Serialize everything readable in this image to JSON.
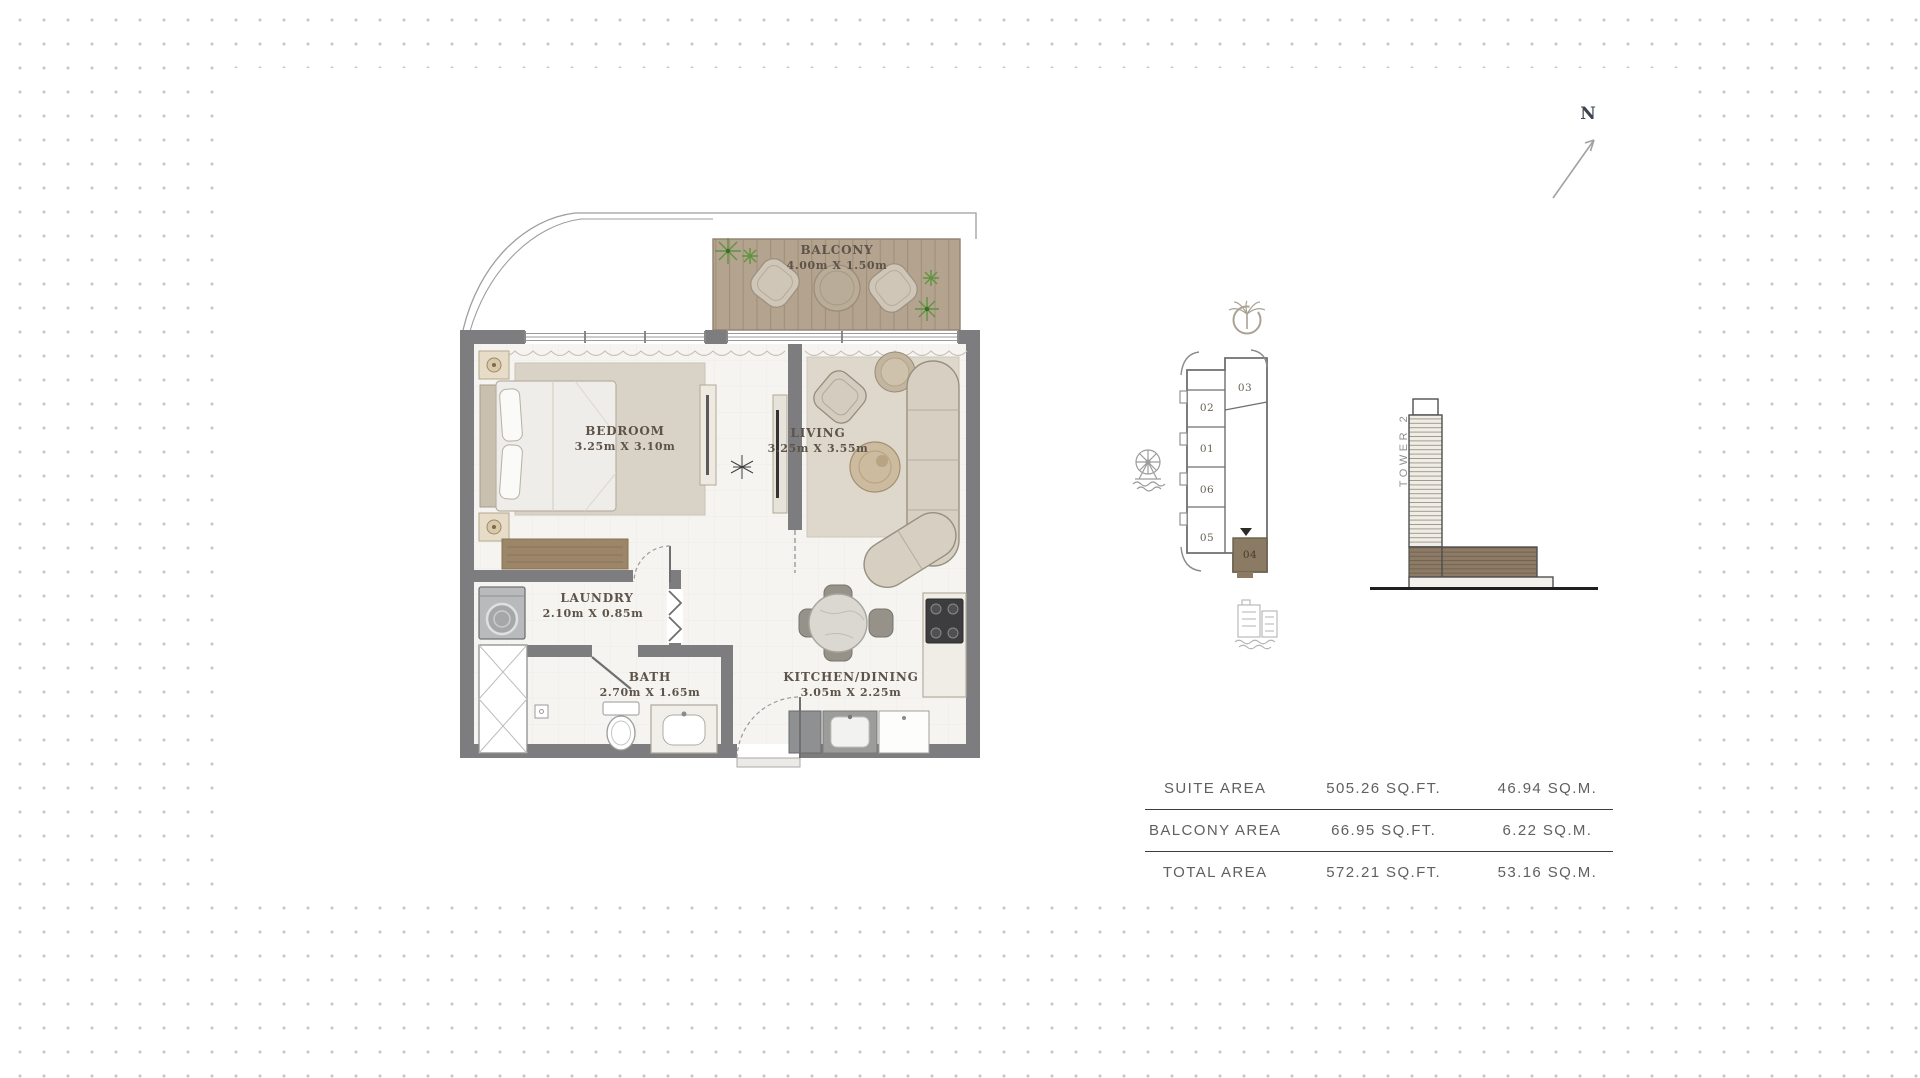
{
  "north_indicator": {
    "label": "N"
  },
  "floor_plan": {
    "rooms": [
      {
        "id": "balcony",
        "name": "BALCONY",
        "dims": "4.00m X 1.50m"
      },
      {
        "id": "bedroom",
        "name": "BEDROOM",
        "dims": "3.25m X 3.10m"
      },
      {
        "id": "living",
        "name": "LIVING",
        "dims": "3.25m X 3.55m"
      },
      {
        "id": "laundry",
        "name": "LAUNDRY",
        "dims": "2.10m X 0.85m"
      },
      {
        "id": "bath",
        "name": "BATH",
        "dims": "2.70m X 1.65m"
      },
      {
        "id": "kitchen_dining",
        "name": "KITCHEN/DINING",
        "dims": "3.05m X 2.25m"
      }
    ]
  },
  "key_plan": {
    "units": [
      {
        "number": "03"
      },
      {
        "number": "02"
      },
      {
        "number": "01"
      },
      {
        "number": "06"
      },
      {
        "number": "05"
      },
      {
        "number": "04"
      }
    ],
    "highlighted_unit": "04",
    "icons": [
      "palm-jumeirah",
      "ferris-wheel",
      "city-skyline"
    ]
  },
  "tower_elevation": {
    "label": "TOWER 2"
  },
  "area_table": {
    "rows": [
      {
        "label": "SUITE AREA",
        "imperial": "505.26 SQ.FT.",
        "metric": "46.94 SQ.M."
      },
      {
        "label": "BALCONY AREA",
        "imperial": "66.95 SQ.FT.",
        "metric": "6.22 SQ.M."
      },
      {
        "label": "TOTAL AREA",
        "imperial": "572.21 SQ.FT.",
        "metric": "53.16 SQ.M."
      }
    ]
  },
  "colors": {
    "highlight_brown": "#8b7a64",
    "wall_gray": "#7d7d7f",
    "deck_wood": "#b4a48f",
    "label_text": "#5d5349",
    "table_text": "#5e6063",
    "dot_grid": "#c6c6c6"
  }
}
